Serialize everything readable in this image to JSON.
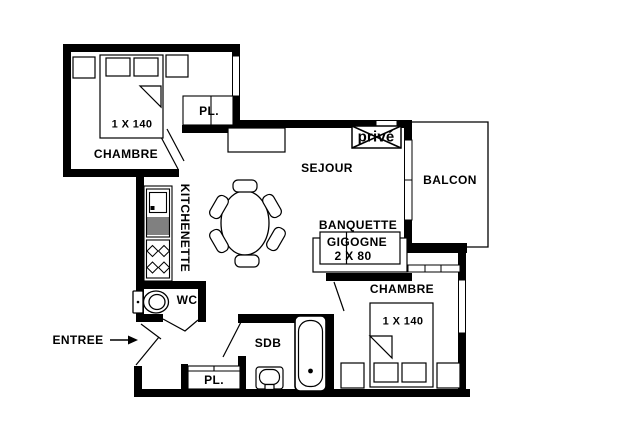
{
  "plan": {
    "labels": {
      "bedroom1": "CHAMBRE",
      "bedroom1_bed": "1 X 140",
      "closet_top": "PL.",
      "kitchenette": "KITCHENETTE",
      "living": "SEJOUR",
      "prive": "privé",
      "balcony": "BALCON",
      "banquette_line1": "BANQUETTE",
      "banquette_line2": "GIGOGNE",
      "banquette_line3": "2 X 80",
      "bedroom2": "CHAMBRE",
      "bedroom2_bed": "1 X 140",
      "wc": "WC",
      "bathroom": "SDB",
      "closet_bottom": "PL.",
      "entrance": "ENTREE"
    },
    "colors": {
      "wall": "#000000",
      "line": "#000000",
      "background": "#ffffff"
    }
  }
}
